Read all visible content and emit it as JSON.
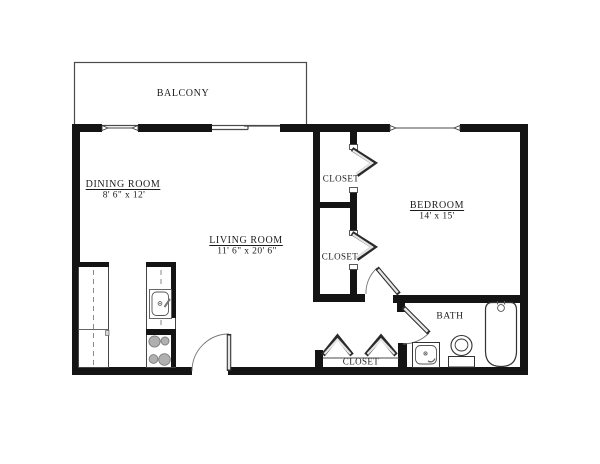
{
  "floor_plan": {
    "balcony": {
      "label": "BALCONY"
    },
    "dining_room": {
      "label": "DINING ROOM",
      "dimensions": "8' 6\" x 12'"
    },
    "living_room": {
      "label": "LIVING ROOM",
      "dimensions": "11' 6\" x 20' 6\""
    },
    "bedroom": {
      "label": "BEDROOM",
      "dimensions": "14' x 15'"
    },
    "bath": {
      "label": "BATH"
    },
    "closet_top": {
      "label": "CLOSET"
    },
    "closet_middle": {
      "label": "CLOSET"
    },
    "closet_bottom": {
      "label": "CLOSET"
    },
    "colors": {
      "wall": "#141414",
      "thin_line": "#4a4a4a",
      "background": "#ffffff",
      "door_fill": "#e6e6e6",
      "burner": "#b0b0b0"
    }
  }
}
